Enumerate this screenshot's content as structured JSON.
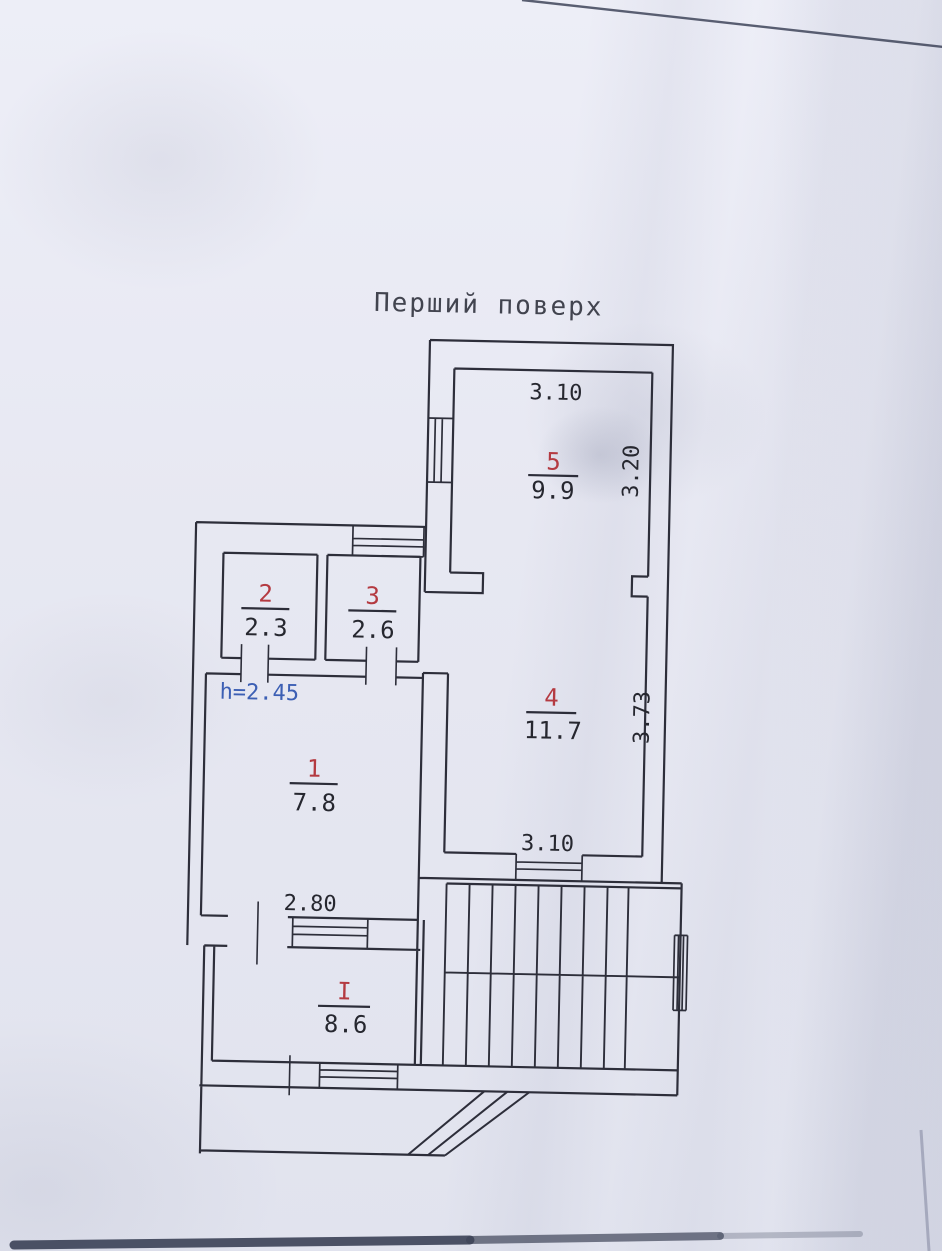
{
  "document": {
    "title": "Перший поверх",
    "height_note": "h=2.45"
  },
  "rooms": {
    "r5": {
      "number": "5",
      "area": "9.9"
    },
    "r2": {
      "number": "2",
      "area": "2.3"
    },
    "r3": {
      "number": "3",
      "area": "2.6"
    },
    "r4": {
      "number": "4",
      "area": "11.7"
    },
    "r1": {
      "number": "1",
      "area": "7.8"
    },
    "rI": {
      "number": "I",
      "area": "8.6"
    }
  },
  "dimensions": {
    "room5_width_top": "3.10",
    "room5_depth_right": "3.20",
    "room4_depth_right": "3.73",
    "room4_width_bottom": "3.10",
    "room1_width_bottom": "2.80"
  },
  "colors": {
    "room_number_red": "#b43a41",
    "dimension_ink": "#26272f",
    "height_note_blue": "#3c5fb4",
    "wall_ink": "#2d2e3a",
    "paper": "#e7e8f2"
  }
}
